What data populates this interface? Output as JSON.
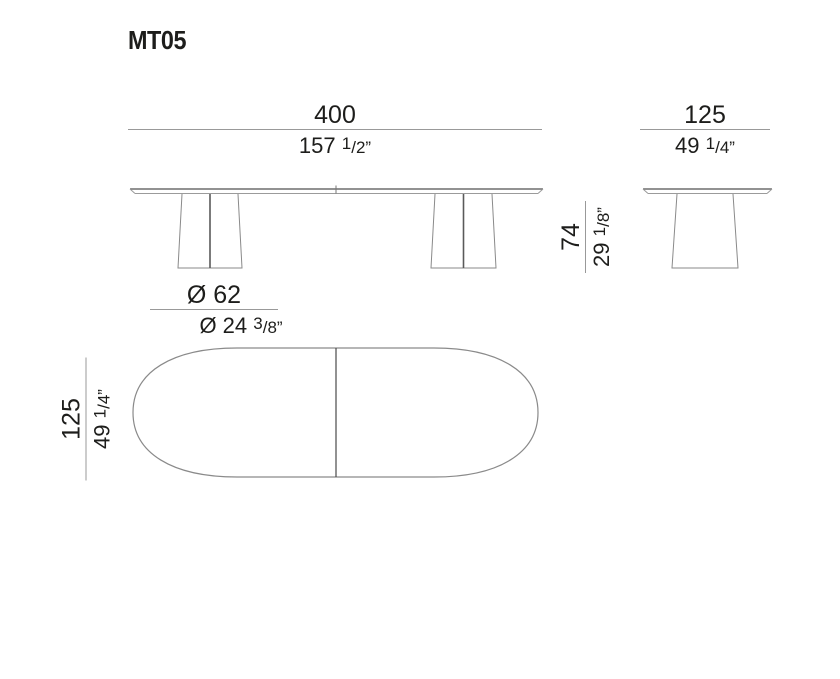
{
  "title": "MT05",
  "colors": {
    "background": "#ffffff",
    "text": "#1d1d1b",
    "drawing_line": "#8a8a8a",
    "drawing_line_dark": "#5a5a5a",
    "dimension_rule": "#999999"
  },
  "dimensions": {
    "length": {
      "metric": "400",
      "imp_whole": "157 ",
      "imp_num": "1",
      "imp_rest": "/2”"
    },
    "depth_side": {
      "metric": "125",
      "imp_whole": "49 ",
      "imp_num": "1",
      "imp_rest": "/4”"
    },
    "height": {
      "metric": "74",
      "imp_whole": "29 ",
      "imp_num": "1",
      "imp_rest": "/8”"
    },
    "leg_diameter": {
      "metric": "Ø 62",
      "imp_whole": "Ø 24 ",
      "imp_num": "3",
      "imp_rest": "/8”"
    },
    "depth_top": {
      "metric": "125",
      "imp_whole": "49 ",
      "imp_num": "1",
      "imp_rest": "/4”"
    }
  },
  "views": {
    "front": "front elevation — tabletop with two pedestal legs",
    "side": "side elevation — tabletop with one pedestal leg",
    "top": "top plan — rounded oval top with centre split line"
  }
}
